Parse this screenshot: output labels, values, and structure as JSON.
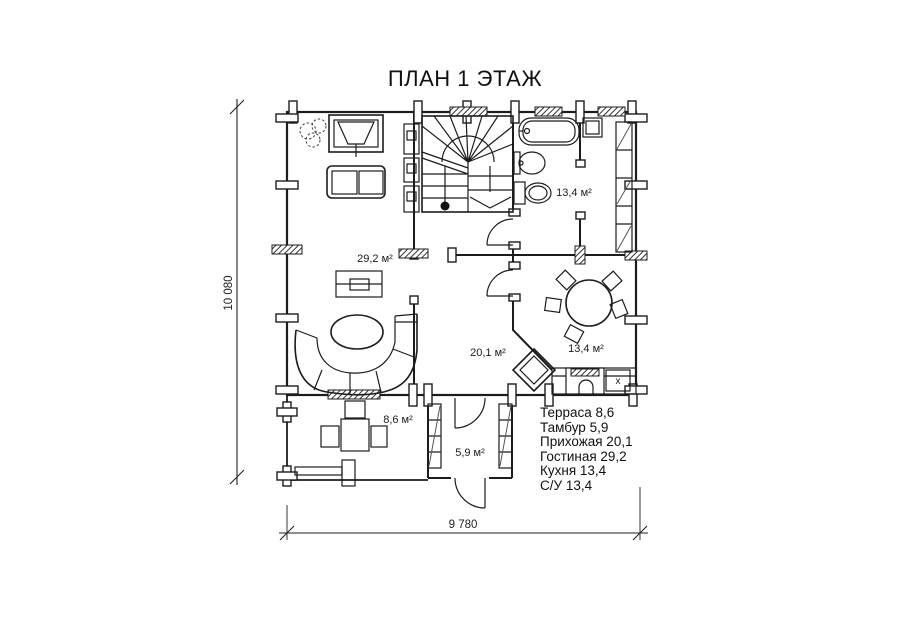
{
  "title": "ПЛАН 1 ЭТАЖ",
  "room_labels": {
    "bathroom": "13,4 м²",
    "living_room": "29,2 м²",
    "hallway": "20,1 м²",
    "kitchen": "13,4 м²",
    "terrace": "8,6 м²",
    "tambour": "5,9 м²"
  },
  "legend": {
    "items": [
      "Терраса 8,6",
      "Тамбур 5,9",
      "Прихожая 20,1",
      "Гостиная 29,2",
      "Кухня 13,4",
      "С/У 13,4"
    ]
  },
  "dimensions": {
    "width": "9 780",
    "height": "10 080"
  },
  "marks": {
    "kitchen_sink": "x"
  },
  "colors": {
    "line": "#1c1c1c",
    "background": "#ffffff"
  }
}
